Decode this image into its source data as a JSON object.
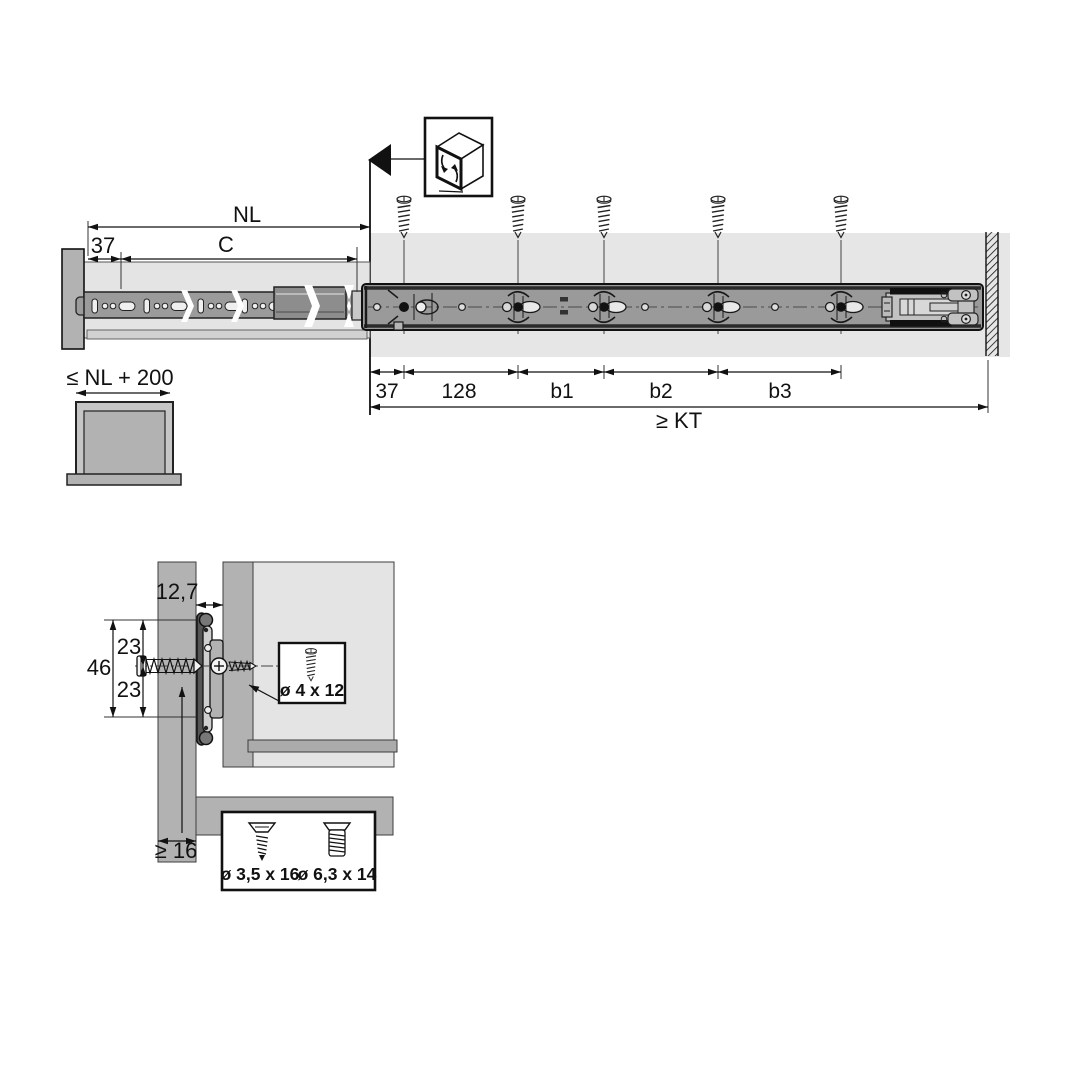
{
  "diagram": "drawer-slide-mounting-dimensions",
  "colors": {
    "line": "#111111",
    "panel_gray": "#b2b2b2",
    "light_gray": "#e6e6e6",
    "drawer_gray": "#e4e4e4",
    "rail_gray": "#9a9a9a",
    "rail_dark": "#8d8d8d",
    "background": "#ffffff"
  },
  "icons": {
    "cabinet_icon": "isometric-cabinet-with-extension-arrows",
    "direction_marker_icon": "left-pointing-filled-triangle"
  },
  "top_view": {
    "labels": {
      "nl": "NL",
      "front_offset": "37",
      "c": "C",
      "offset": "37",
      "pitch": "128",
      "b1": "b1",
      "b2": "b2",
      "b3": "b3",
      "kt": "≥ KT",
      "drawer_max_length": "≤ NL + 200"
    }
  },
  "section_view": {
    "labels": {
      "gap": "12,7",
      "height_total": "46",
      "height_upper": "23",
      "height_lower": "23",
      "min_thickness": "≥ 16"
    },
    "screws": {
      "side": "ø 4 x 12",
      "bottom_a": "ø 3,5 x 16",
      "bottom_b": "ø 6,3 x 14"
    }
  }
}
